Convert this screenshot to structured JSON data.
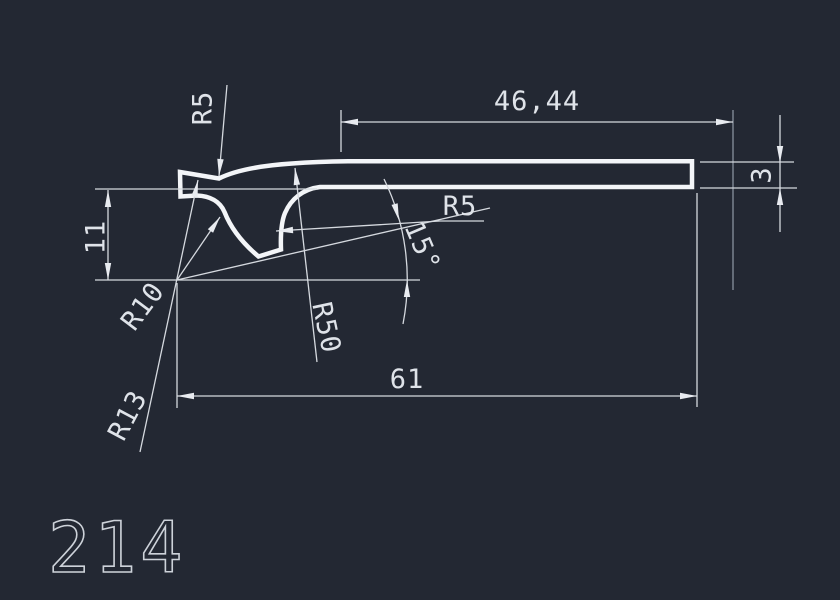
{
  "canvas": {
    "background_color": "#232833",
    "profile_line_color": "#f3f5f8",
    "dimension_line_color": "#d5d9df",
    "text_color": "#dfe3e9"
  },
  "labels": {
    "dim_length_top": "46,44",
    "dim_length_bottom": "61",
    "dim_thickness": "3",
    "dim_height": "11",
    "radius_top": "R5",
    "radius_fillet": "R5",
    "radius_large": "R50",
    "radius_small": "R10",
    "radius_left": "R13",
    "angle": "15°",
    "part_number": "214"
  }
}
